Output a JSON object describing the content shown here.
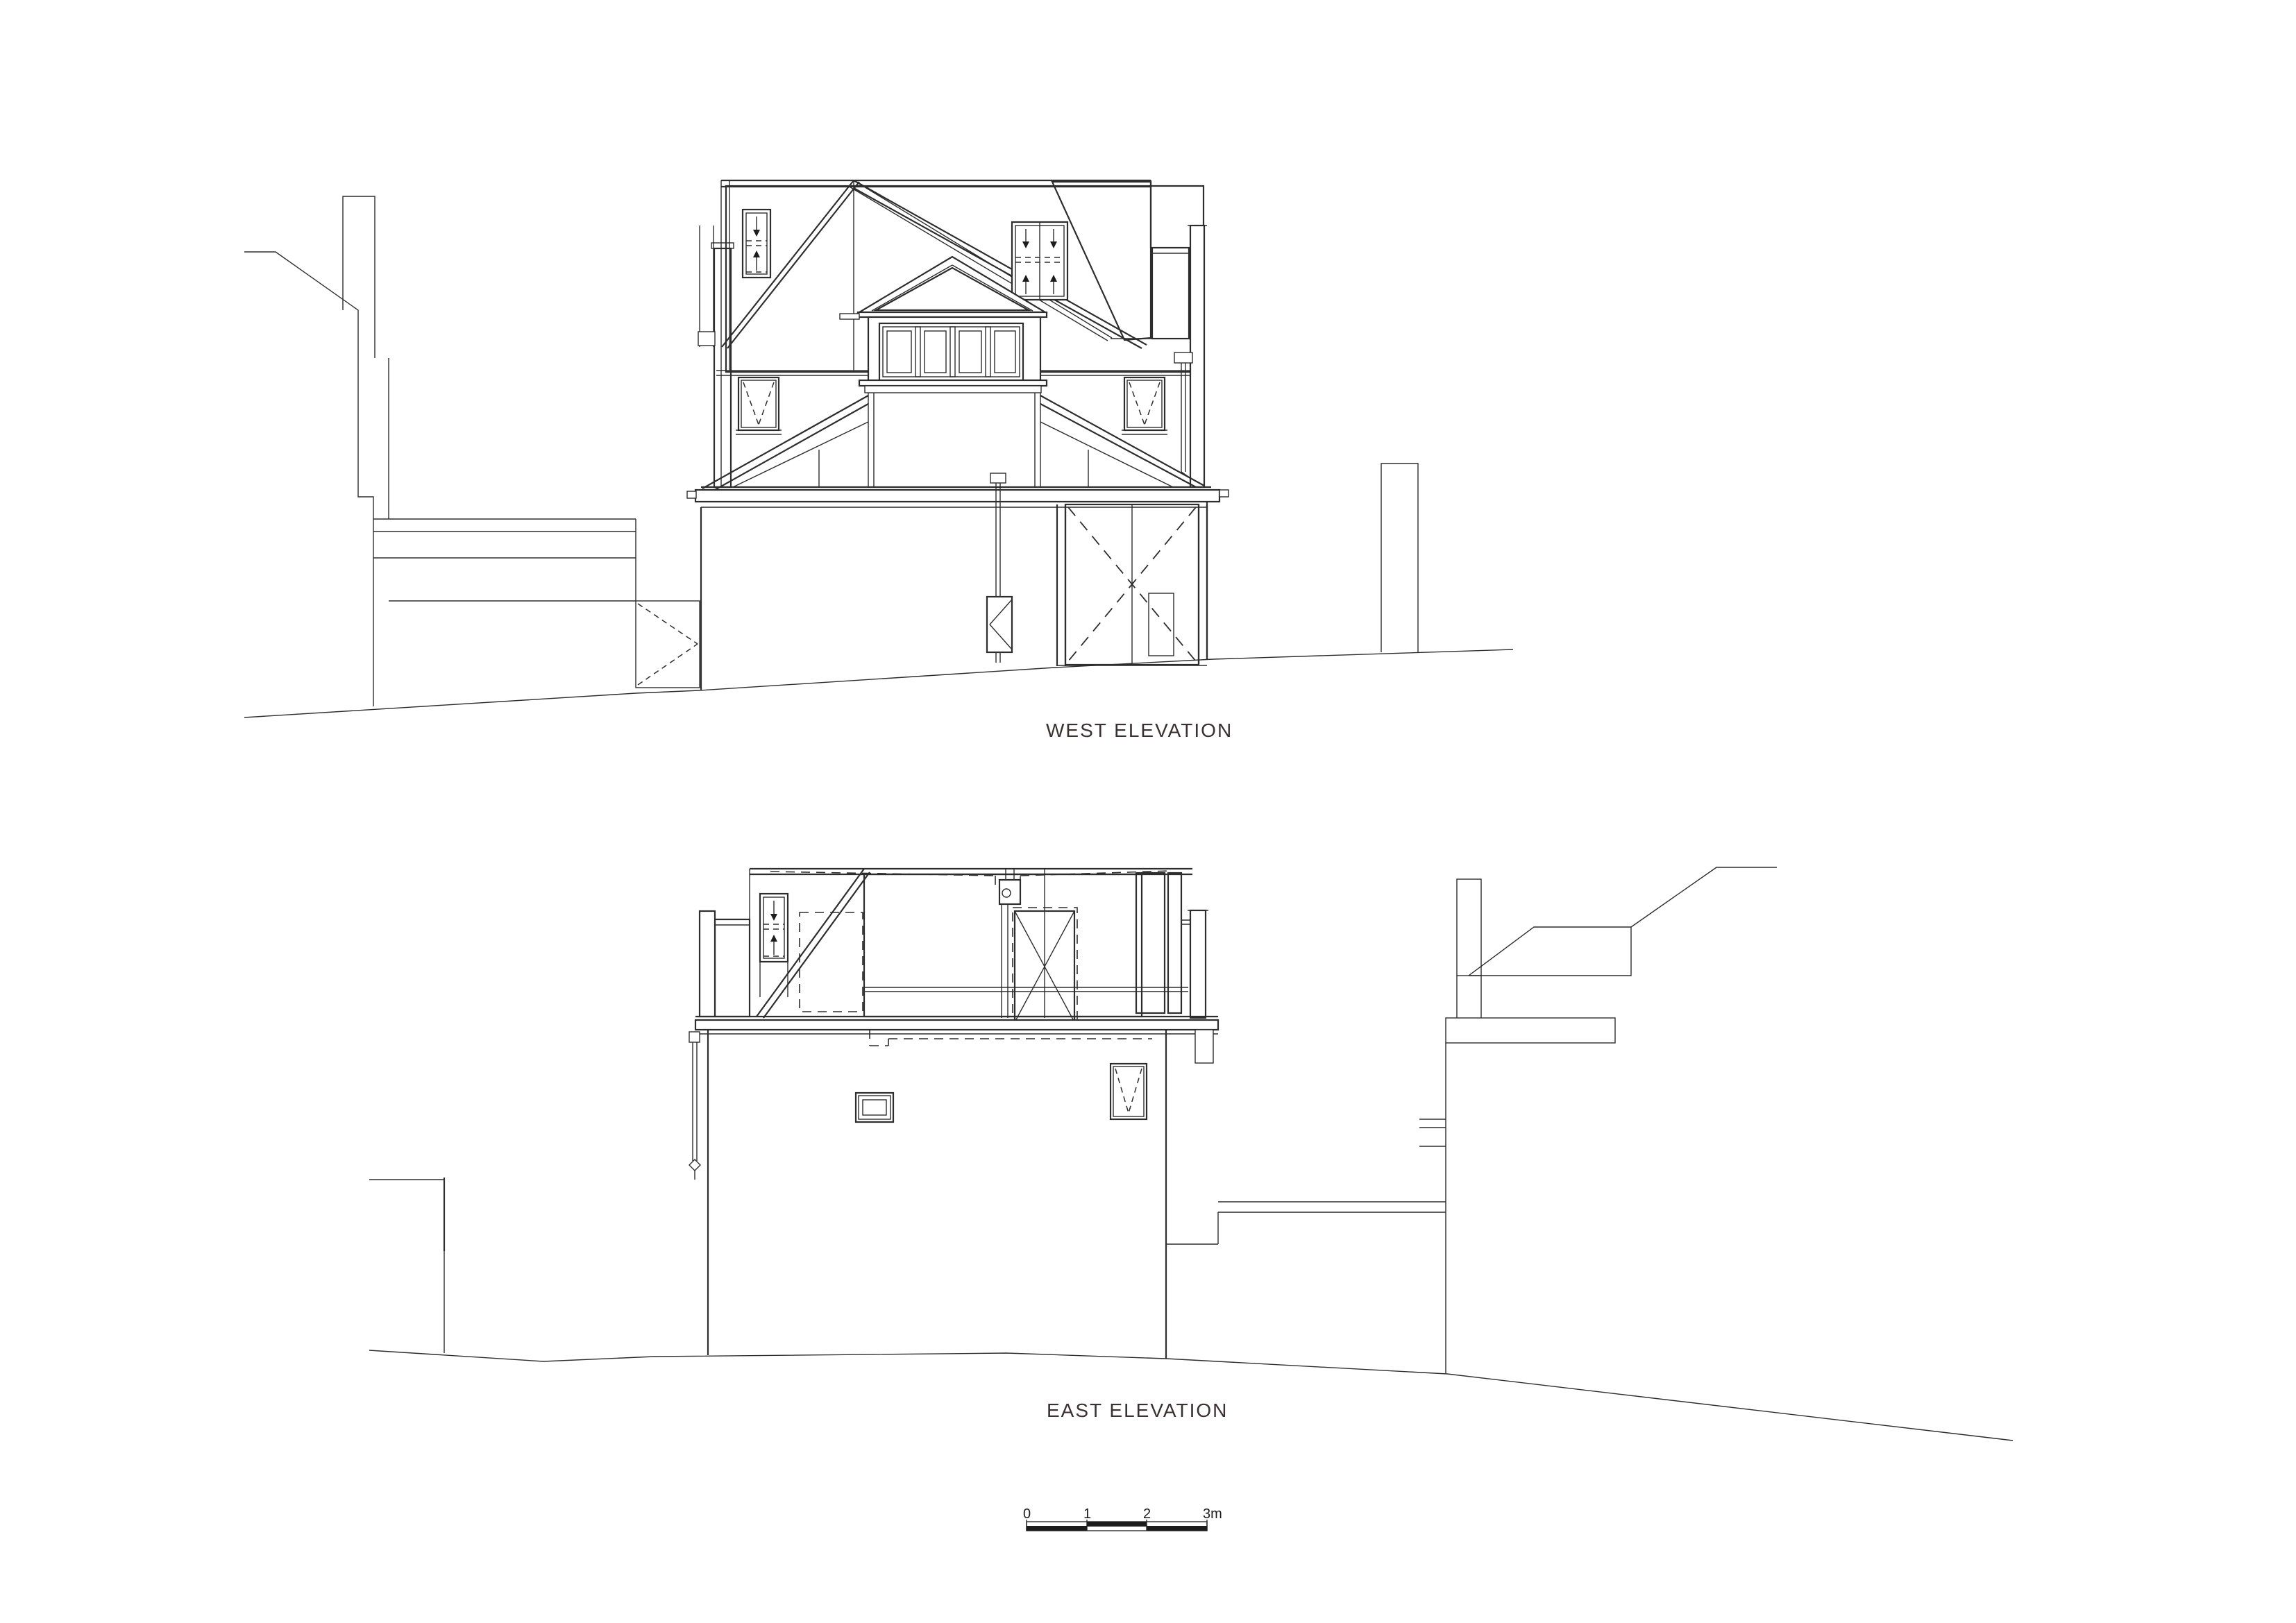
{
  "sheet": {
    "background": "#ffffff",
    "line_color": "#2d2d2d",
    "title_color": "#3a2f31",
    "kind": "architectural elevation drawing, two elevations with scale bar"
  },
  "labels": {
    "west_title": "WEST ELEVATION",
    "east_title": "EAST ELEVATION"
  },
  "scalebar": {
    "tick_0": "0",
    "tick_1": "1",
    "tick_2": "2",
    "tick_3": "3m",
    "unit": "m"
  }
}
